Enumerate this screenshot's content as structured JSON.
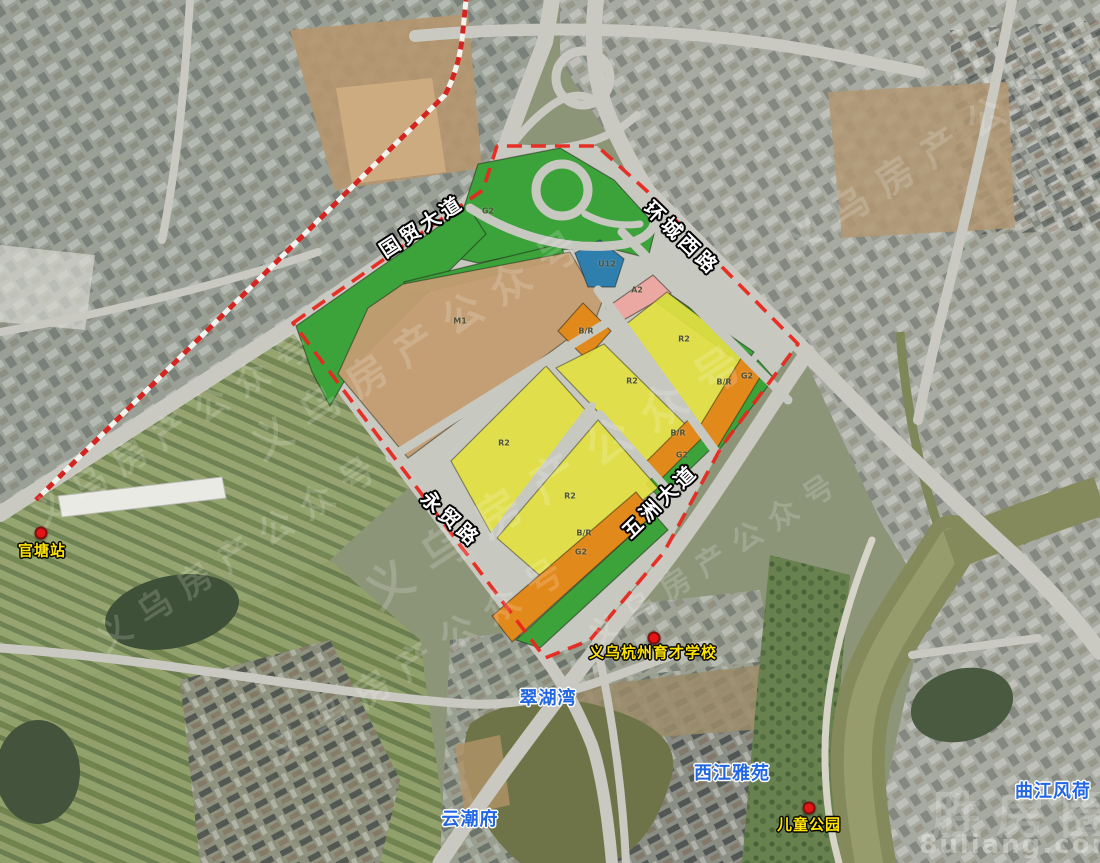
{
  "road_labels": [
    "国贸大道",
    "环城西路",
    "永贸路",
    "五洲大道"
  ],
  "place_labels": {
    "station": "官塘站",
    "school": "义乌杭州育才学校",
    "kids_park": "儿童公园",
    "cuihuwan": "翠湖湾",
    "xijiang_yayuan": "西江雅苑",
    "yunchaofu": "云潮府",
    "qujiang_fenghe": "曲江风荷"
  },
  "plan_overlay": {
    "boundary_color": "#e8281e",
    "zone_colors": {
      "R2": "#e3e041",
      "BR": "#e2891c",
      "M1": "#c49d72",
      "G2": "#3ca23a",
      "A2": "#eba8a2",
      "U12": "#2f7fae",
      "road": "#c7c8c0"
    },
    "zone_labels": [
      "G2",
      "M1",
      "U12",
      "A2",
      "B/R",
      "R2",
      "G2",
      "B/R",
      "R2",
      "R2",
      "B/R",
      "G2",
      "R2",
      "B/R",
      "G2"
    ]
  },
  "watermarks": {
    "brand": "义乌房产公众号",
    "site": "8uliang.com",
    "site_logo": "胜房圈"
  }
}
